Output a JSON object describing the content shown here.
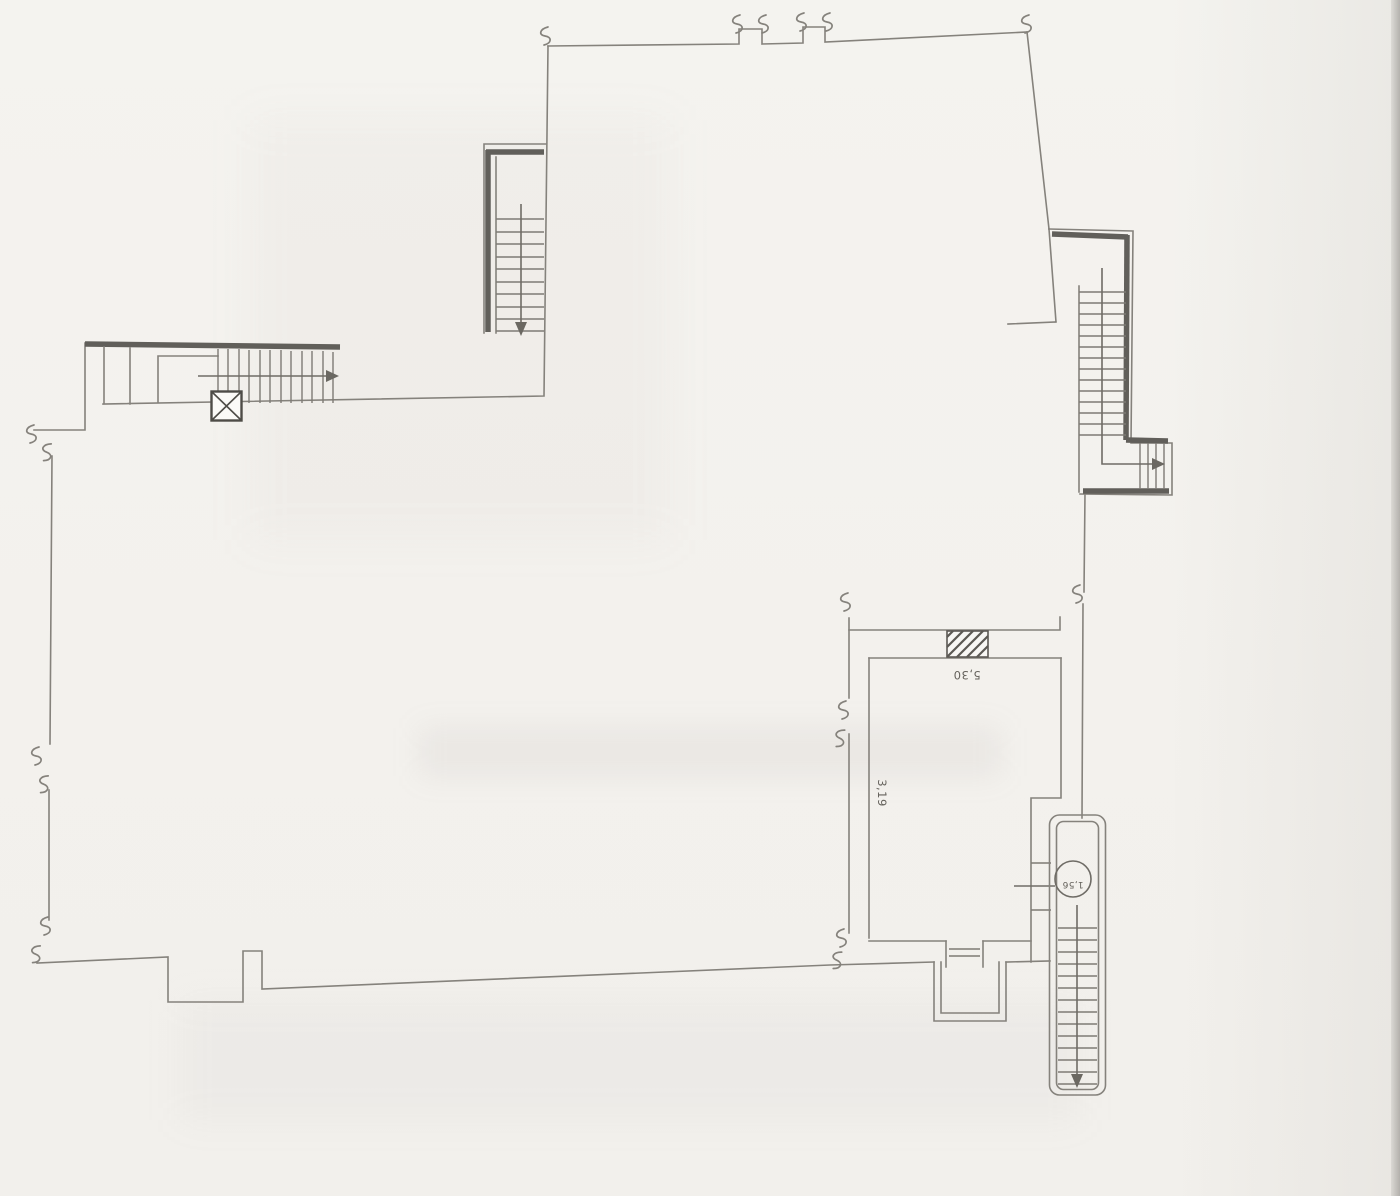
{
  "drawing": {
    "labels": {
      "room_width": "5,30",
      "room_depth": "3,19",
      "stair_circle": "1,56"
    },
    "colors": {
      "paper": "#f3f1ed",
      "line": "#85827c",
      "wall": "#615f5a",
      "ink": "#55524c"
    }
  }
}
